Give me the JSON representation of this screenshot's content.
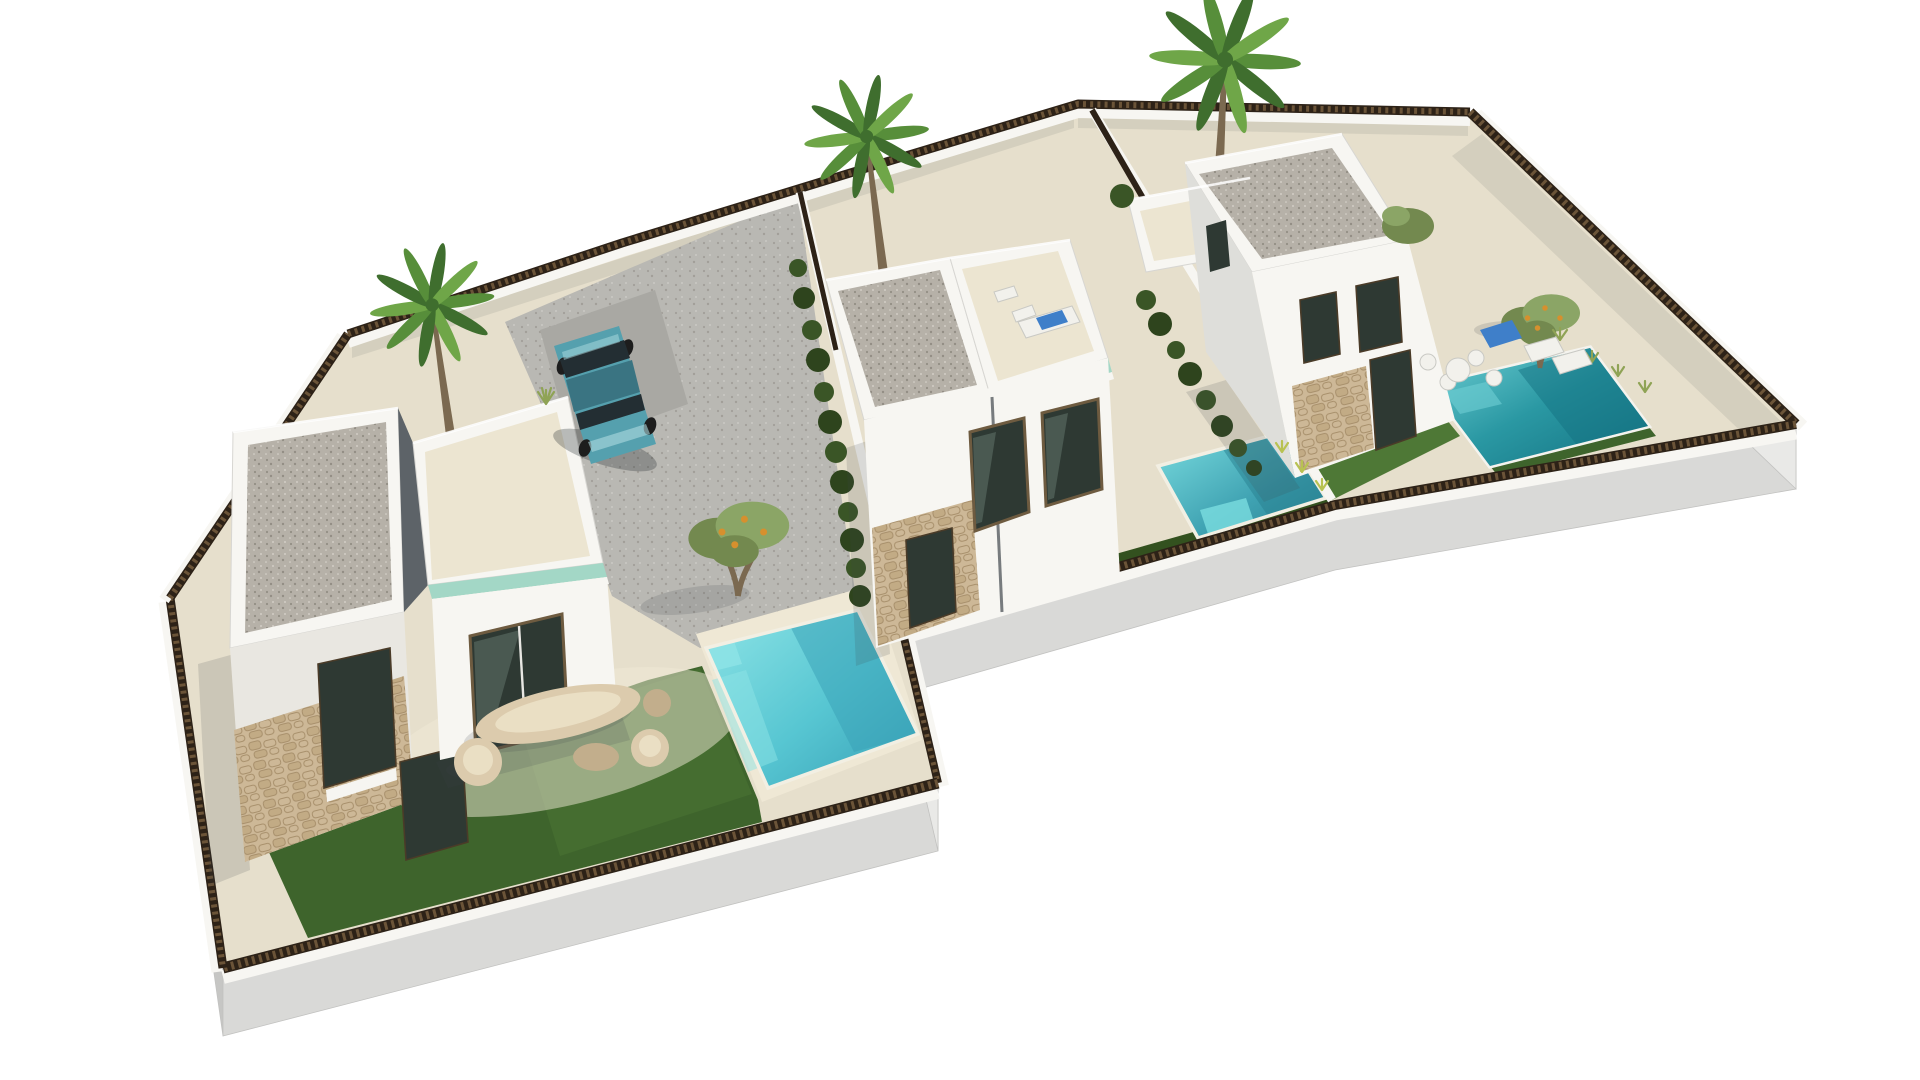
{
  "scene": {
    "setting": "aerial 3d architectural render of three modern white villas with private pools on a plain white background",
    "villas": [
      {
        "id": "villa-left",
        "features": [
          "gravel flat roof",
          "roof terrace with glass balustrade",
          "stone clad ground floor",
          "round garden furniture set",
          "lawn",
          "turquoise pool",
          "olive tree",
          "gravel driveway with parked car"
        ]
      },
      {
        "id": "villa-middle",
        "features": [
          "gravel flat roof",
          "roof terrace with sun lounger and blue towel",
          "two sliding glass doors",
          "stone clad corner",
          "teal pool along boundary",
          "dark lawn strip"
        ]
      },
      {
        "id": "villa-right",
        "features": [
          "gravel flat roof",
          "rear roof terrace",
          "stone clad ground floor",
          "large green lawn",
          "dark teal pool with white rim",
          "sun loungers and chairs",
          "olive tree and shrubs"
        ]
      }
    ],
    "trees": {
      "palms": 3,
      "olives": 2,
      "hedges": 2
    },
    "vehicles": {
      "car": "teal hatchback parked in driveway"
    }
  },
  "colors": {
    "bg": "#ffffff",
    "ground": "#e6dfcc",
    "groundLight": "#f0e9d6",
    "poolDeck": "#efe8d5",
    "driveBase": "#b9b8b3",
    "parkingPad": "#a9a8a3",
    "lawn": "#3e642c",
    "lawnLight": "#4e7836",
    "lawnStrip": "#33511f",
    "pool1Light": "#8ee4e6",
    "pool1Mid": "#57c6d2",
    "pool1Dark": "#379fb5",
    "pool2Light": "#7adde0",
    "pool2Mid": "#3fa2b2",
    "pool2Dark": "#27808f",
    "pool3Light": "#6fcfd4",
    "pool3Mid": "#2a98a3",
    "pool3Dark": "#137181",
    "wallLit": "#f7f6f2",
    "wallWarm": "#e9e7e1",
    "wallMid": "#dededa",
    "wallShade": "#c9cac8",
    "wallDark": "#5d6368",
    "gravelBase": "#b6b1a8",
    "gravelDot1": "#938e85",
    "gravelDot2": "#dad6ce",
    "driveDot1": "#a29f99",
    "driveDot2": "#cfcec9",
    "cream": "#ece5d1",
    "glass": "#a3d7c6",
    "stoneBase": "#cdb897",
    "stoneUnit": "#c2ab85",
    "stoneLine": "#a8906c",
    "windowGlass": "#2e3933",
    "windowRefl": "#7e948a",
    "fence": "#2d2217",
    "fenceSlat": "#6b5438",
    "plinthLit": "#e9e9e7",
    "plinthMid": "#d9d9d7",
    "plinthDark": "#c6c6c4",
    "palmGreen1": "#3f6e2e",
    "palmGreen2": "#578e3a",
    "palmGreen3": "#6fa648",
    "trunk": "#7b6950",
    "oliveGreen": "#73894f",
    "oliveLight": "#8ba566",
    "orange": "#d6902e",
    "hedge": "#3a5526",
    "hedgeDark": "#2e441d",
    "carBody": "#55a0ae",
    "carDark": "#3a7482",
    "carGlass": "#232e33",
    "carLight": "#aedbe0",
    "blueTowel": "#3f7fc9",
    "furnBeige": "#dccbad",
    "furnDark": "#c2ae8c",
    "furnLight": "#eadfc4",
    "sill": "#f6f5f1",
    "tuft": "#8fa355",
    "tuftYellow": "#b8c252"
  }
}
